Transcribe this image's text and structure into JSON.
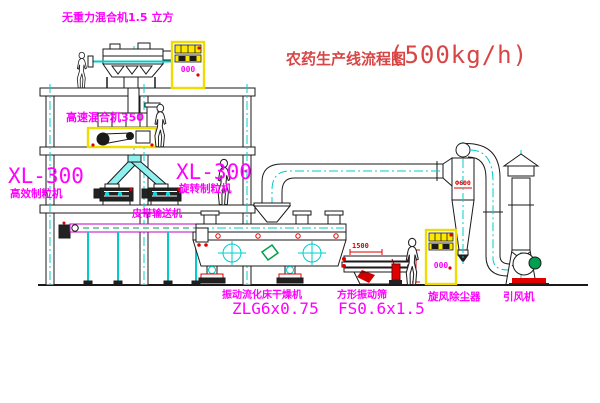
{
  "title": {
    "text": "农药生产线流程图",
    "capacity": "(500kg/h)"
  },
  "equipment_labels": {
    "gravity_mixer": "无重力混合机1.5 立方",
    "high_speed_mixer": "高速混合机350",
    "granulator_left": {
      "model": "XL-300",
      "name": "高效制粒机"
    },
    "granulator_right": {
      "model": "XL-300",
      "name": "旋转制粒机"
    },
    "belt_conveyor": "皮带输送机",
    "fluid_bed_dryer": {
      "name": "振动流化床干燥机",
      "model": "ZLG6x0.75"
    },
    "vibrating_screen": {
      "name": "方形振动筛",
      "model": "FS0.6x1.5"
    },
    "cyclone": "旋风除尘器",
    "induced_draft_fan": "引风机"
  },
  "annotations": {
    "screen_dim": "1500",
    "cyclone_dim": "Ф600",
    "cabinet_display": "000"
  },
  "colors": {
    "label_magenta": "#ff00ff",
    "title_red": "#d94545",
    "centerline_cyan": "#00cccc",
    "cabinet_yellow": "#f0dc00",
    "accent_red": "#e00000",
    "machine_green": "#00a050",
    "line_black": "#1a1a1a"
  }
}
